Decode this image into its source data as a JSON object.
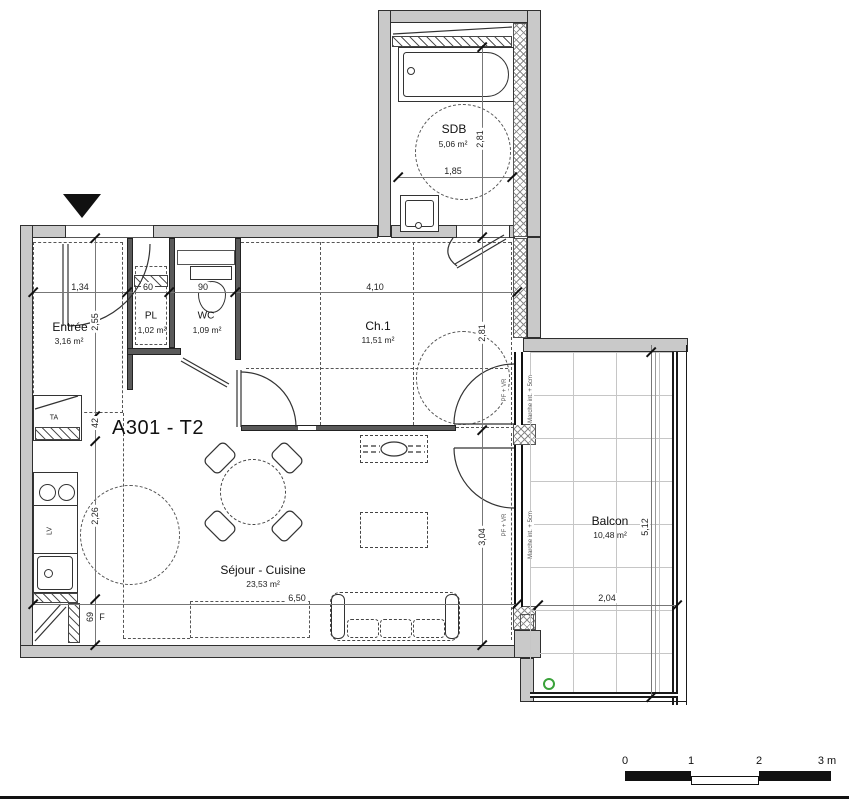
{
  "title": "A301 - T2",
  "rooms": {
    "sdb": {
      "name": "SDB",
      "area": "5,06 m²"
    },
    "entree": {
      "name": "Entrée",
      "area": "3,16 m²"
    },
    "pl": {
      "name": "PL",
      "area": "1,02 m²"
    },
    "wc": {
      "name": "WC",
      "area": "1,09 m²"
    },
    "ch1": {
      "name": "Ch.1",
      "area": "11,51 m²"
    },
    "sejour": {
      "name": "Séjour - Cuisine",
      "area": "23,53 m²"
    },
    "balcon": {
      "name": "Balcon",
      "area": "10,48 m²"
    }
  },
  "dims": {
    "entree_w": "1,34",
    "pl_w": "60",
    "wc_w": "90",
    "ch1_w": "4,10",
    "entree_d": "2,55",
    "ta_d": "42",
    "kitchen_d": "2,26",
    "fridge_d": "69",
    "sdb_d": "2,81",
    "sdb_w": "1,85",
    "ch1_d": "2,81",
    "sejour_d": "3,04",
    "sejour_w": "6,50",
    "balcon_w": "2,04",
    "balcon_d": "5,12"
  },
  "fixtures": {
    "ta": "TA",
    "lv": "LV",
    "fridge": "F"
  },
  "notes": {
    "window": "PF + VR",
    "step": "Marche int. + 5cm"
  },
  "scale_bar": {
    "t0": "0",
    "t1": "1",
    "t2": "2",
    "t3": "3 m"
  },
  "colors": {
    "wall_fill": "#c9c9c9",
    "line": "#1a1a1a",
    "drain_green": "#3aa23a"
  }
}
